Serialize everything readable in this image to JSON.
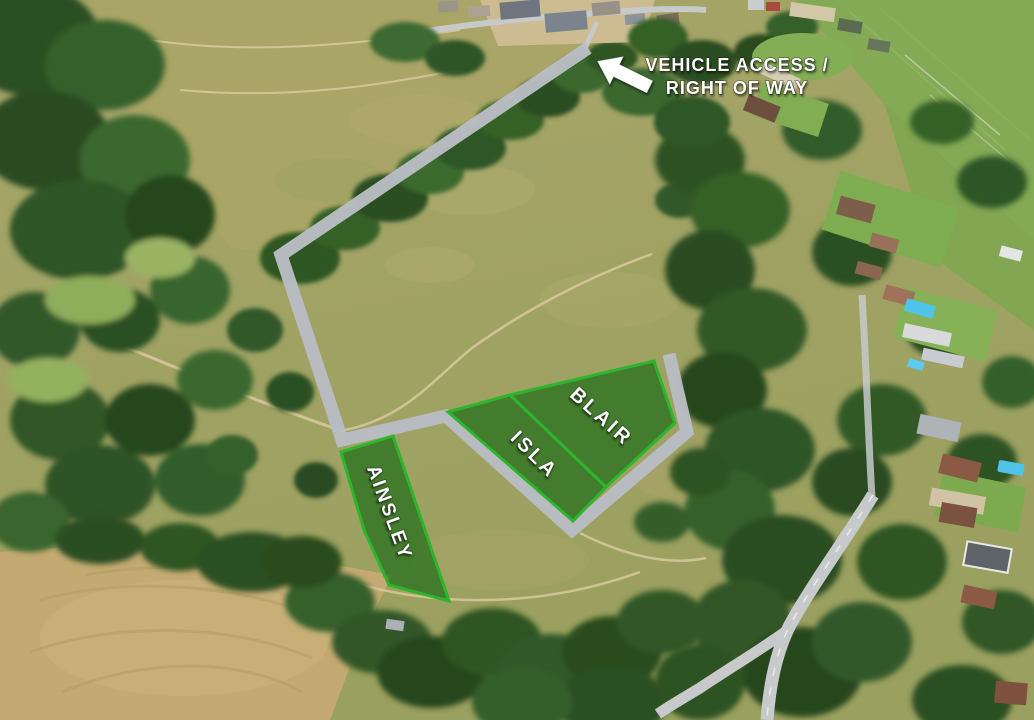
{
  "map": {
    "description": "aerial-photo-plot-map",
    "access_annotation": {
      "line1": "VEHICLE ACCESS /",
      "line2": "RIGHT OF WAY",
      "arrow_icon": "arrow-up-left-icon"
    },
    "plots": [
      {
        "name": "AINSLEY"
      },
      {
        "name": "ISLA"
      },
      {
        "name": "BLAIR"
      }
    ]
  },
  "colors": {
    "plot_border": "#2db52d",
    "plot_fill": "rgba(22,105,20,0.66)",
    "route_gray": "#b9bdc3",
    "annotation_text": "#ffffff"
  }
}
